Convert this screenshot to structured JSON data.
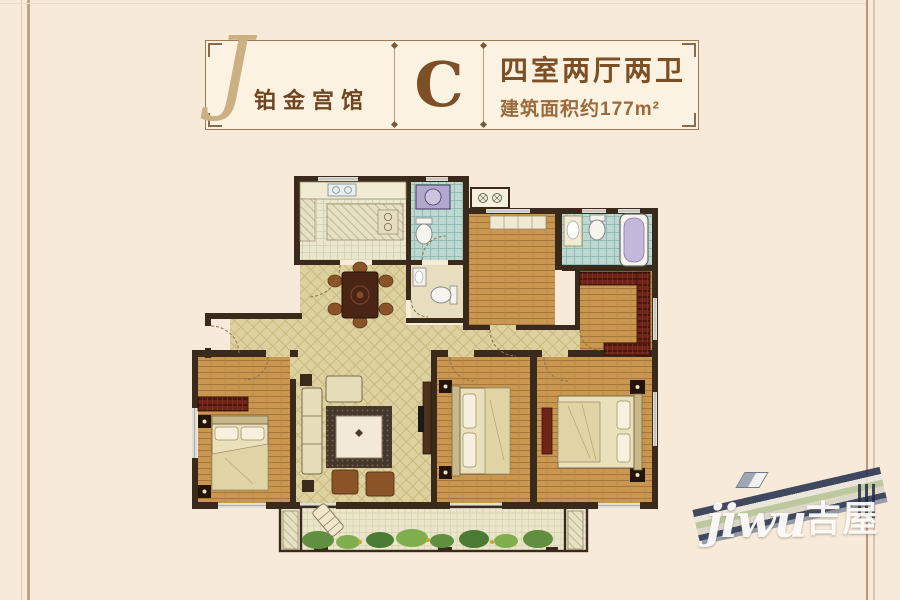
{
  "page": {
    "background_color": "#f8ead9"
  },
  "frame": {
    "left_line_inner": "#e3c7b5",
    "left_line_outer": "#c79f8c",
    "right_line_inner": "#bb9480",
    "right_line_outer": "#dcc2b0",
    "top_line": "#eddac8"
  },
  "header": {
    "logo_initial": "J",
    "project_name": "铂金宫馆",
    "unit_letter": "C",
    "unit_layout": "四室两厅两卫",
    "unit_area_label": "建筑面积约177m²",
    "border_color": "#9b7a58",
    "text_color": "#7d4f27"
  },
  "floorplan": {
    "type": "apartment-floor-plan",
    "rooms": [
      "entry-hall",
      "kitchen",
      "bathroom-1",
      "guest-bathroom",
      "dining-room",
      "study-bedroom",
      "master-bathroom",
      "walk-in-closet",
      "living-room",
      "bedroom-2",
      "bedroom-3",
      "master-bedroom",
      "balcony"
    ],
    "palette": {
      "wall": "#3a2a1c",
      "wood_floor": "#c9974f",
      "lattice_floor": "#ddd1a0",
      "bath_tile": "#bdd8d0",
      "kitchen_tile": "#eae7cf",
      "balcony_tile": "#eae6cb",
      "wardrobe": "#6e2418",
      "window": "#dedfd6",
      "bed": "#eae0ba",
      "washer": "#b2a8ce",
      "bathtub_inner": "#c3b7da",
      "plants": "#5f8f3f"
    }
  },
  "watermark": {
    "latin": "jiwu",
    "cjk": "吉屋",
    "color": "#ffffff"
  }
}
